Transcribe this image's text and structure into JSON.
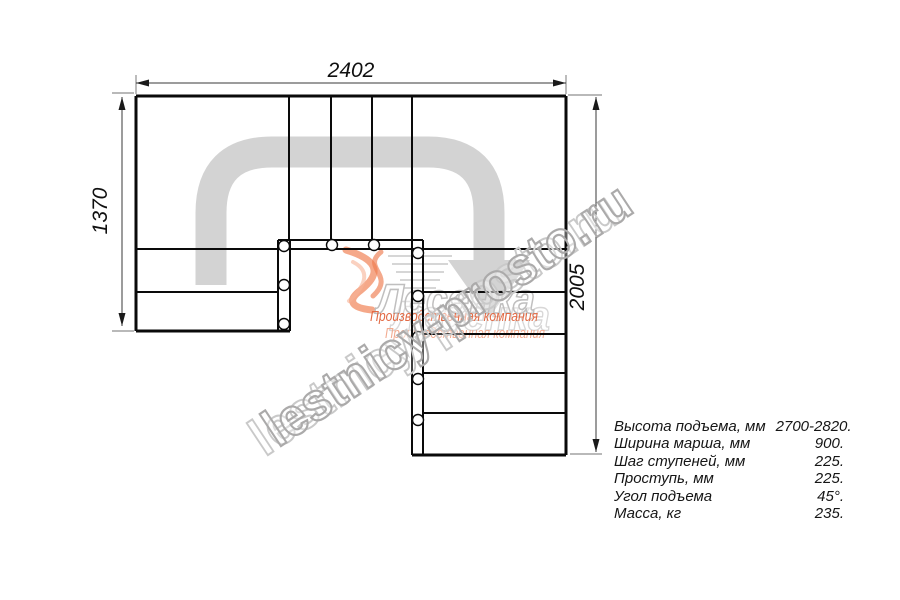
{
  "drawing": {
    "title_dimensions": {
      "top_width_mm": "2402",
      "left_height_mm": "1370",
      "right_height_mm": "2005"
    },
    "specs": [
      {
        "label": "Высота подъема, мм",
        "value": "2700-2820."
      },
      {
        "label": "Ширина марша, мм",
        "value": "900."
      },
      {
        "label": "Шаг ступеней, мм",
        "value": "225."
      },
      {
        "label": "Проступь, мм",
        "value": "225."
      },
      {
        "label": "Угол подъема",
        "value": "45°."
      },
      {
        "label": "Масса, кг",
        "value": "235."
      }
    ],
    "watermark": {
      "site": "lestnicy-prosto.ru"
    },
    "logo": {
      "name": "Лесенка",
      "tagline": "Производственная компания"
    },
    "colors": {
      "walkline_gray": "#d3d3d3",
      "logo_orange": "#e26a45",
      "watermark_gray": "#abaaaa",
      "line_black": "#0a0a0a"
    }
  }
}
